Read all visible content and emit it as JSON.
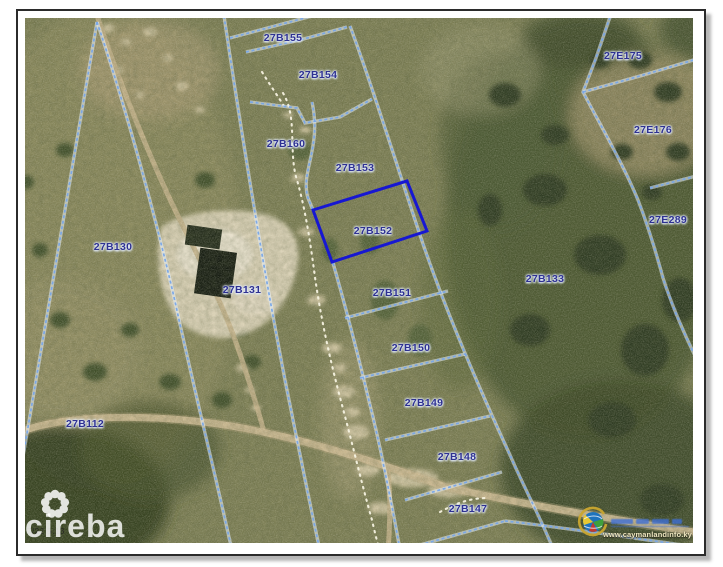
{
  "window": {
    "background": "#ffffff",
    "frame_border": "#2b2b2b"
  },
  "map": {
    "highlight_color": "#1717d2",
    "boundary_color": "#78a6e8",
    "label_color": "#2e3192",
    "parcel_labels": [
      {
        "id": "27B155",
        "x": 283,
        "y": 38,
        "highlighted": false
      },
      {
        "id": "27B154",
        "x": 318,
        "y": 75,
        "highlighted": false
      },
      {
        "id": "27B160",
        "x": 286,
        "y": 144,
        "highlighted": false
      },
      {
        "id": "27B153",
        "x": 355,
        "y": 168,
        "highlighted": false
      },
      {
        "id": "27B152",
        "x": 373,
        "y": 231,
        "highlighted": true
      },
      {
        "id": "27B151",
        "x": 392,
        "y": 293,
        "highlighted": false
      },
      {
        "id": "27B150",
        "x": 411,
        "y": 348,
        "highlighted": false
      },
      {
        "id": "27B149",
        "x": 424,
        "y": 403,
        "highlighted": false
      },
      {
        "id": "27B148",
        "x": 457,
        "y": 457,
        "highlighted": false
      },
      {
        "id": "27B147",
        "x": 468,
        "y": 509,
        "highlighted": false
      },
      {
        "id": "27B130",
        "x": 113,
        "y": 247,
        "highlighted": false
      },
      {
        "id": "27B131",
        "x": 242,
        "y": 290,
        "highlighted": false
      },
      {
        "id": "27B112",
        "x": 85,
        "y": 424,
        "highlighted": false
      },
      {
        "id": "27B133",
        "x": 545,
        "y": 279,
        "highlighted": false
      },
      {
        "id": "27E175",
        "x": 623,
        "y": 56,
        "highlighted": false
      },
      {
        "id": "27E176",
        "x": 653,
        "y": 130,
        "highlighted": false
      },
      {
        "id": "27E289",
        "x": 668,
        "y": 220,
        "highlighted": false
      }
    ]
  },
  "watermarks": {
    "cireba_text": "cireba",
    "timestamp_fragment": "7/22 5:13",
    "landinfo_url": "www.caymanlandinfo.ky"
  }
}
